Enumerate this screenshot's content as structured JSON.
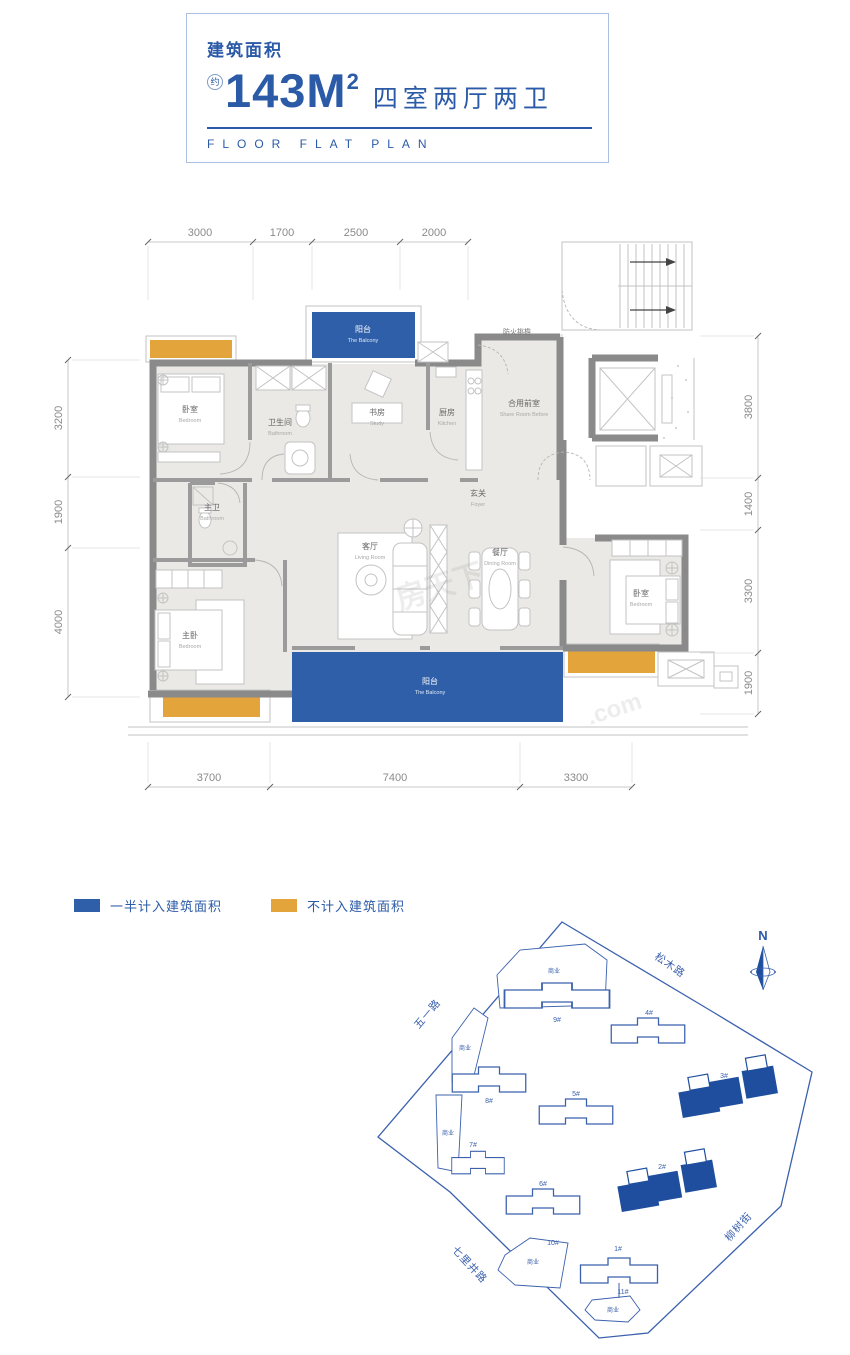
{
  "header": {
    "area_label": "建筑面积",
    "approx": "约",
    "area_value": "143M",
    "area_sup": "2",
    "rooms_spec": "四室两厅两卫",
    "subtitle": "FLOOR FLAT PLAN"
  },
  "colors": {
    "title_blue": "#2b5aa7",
    "balcony_blue": "#2e5fa8",
    "uncounted_orange": "#e3a43c",
    "site_outline_blue": "#3b61ad",
    "site_highlight_blue": "#1e4e9d",
    "wall_gray": "#8a8a8a",
    "floor_gray": "#eae9e5"
  },
  "dims": {
    "top": [
      "3000",
      "1700",
      "2500",
      "2000"
    ],
    "left": [
      "3200",
      "1900",
      "4000"
    ],
    "right": [
      "3800",
      "1400",
      "3300",
      "1900"
    ],
    "bottom": [
      "3700",
      "7400",
      "3300"
    ]
  },
  "rooms": {
    "balcony_top": {
      "cn": "阳台",
      "en": "The Balcony"
    },
    "bedroom_tl": {
      "cn": "卧室",
      "en": "Bedroom"
    },
    "bathroom": {
      "cn": "卫生间",
      "en": "Bathroom"
    },
    "study": {
      "cn": "书房",
      "en": "Study"
    },
    "kitchen": {
      "cn": "厨房",
      "en": "Kitchen"
    },
    "fire_eave": {
      "cn": "防火挑檐"
    },
    "share_room": {
      "cn": "合用前室",
      "en": "Share Room Before"
    },
    "foyer": {
      "cn": "玄关",
      "en": "Foyer"
    },
    "master_bath": {
      "cn": "主卫",
      "en": "Bathroom"
    },
    "living": {
      "cn": "客厅",
      "en": "Living Room"
    },
    "dining": {
      "cn": "餐厅",
      "en": "Dining Room"
    },
    "master_bed": {
      "cn": "主卧",
      "en": "Bedroom"
    },
    "bedroom_r": {
      "cn": "卧室",
      "en": "Bedroom"
    },
    "balcony_btm": {
      "cn": "阳台",
      "en": "The Balcony"
    }
  },
  "legend": {
    "half": {
      "label": "一半计入建筑面积",
      "color": "#2e5fa8"
    },
    "none": {
      "label": "不计入建筑面积",
      "color": "#e3a43c"
    }
  },
  "siteplan": {
    "north": "N",
    "roads": {
      "songmu": "松木路",
      "wuyi": "五一路",
      "qilijing": "七里井路",
      "liushu": "柳树街"
    },
    "commercial": "商业",
    "buildings": {
      "b9": "9#",
      "b4": "4#",
      "b8": "8#",
      "b5": "5#",
      "b3": "3#",
      "b7": "7#",
      "b6": "6#",
      "b2": "2#",
      "b10": "10#",
      "b1": "1#",
      "b11": "11#"
    }
  },
  "watermark": {
    "cn": "房天下",
    "com": ".com"
  }
}
